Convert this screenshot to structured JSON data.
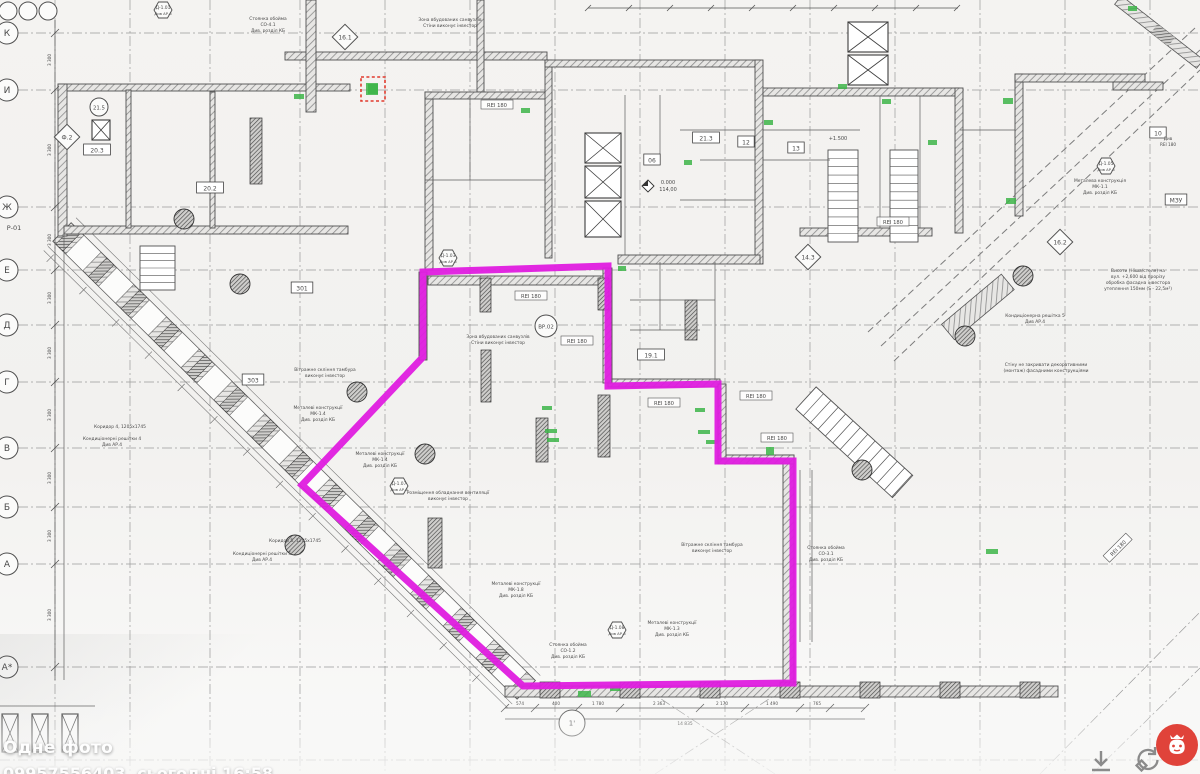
{
  "overlay": {
    "title": "Одне фото",
    "subtitle": "09957556403, сьогодні 16:58"
  },
  "controls": {
    "download_icon": "download-arrow",
    "rotate_icon": "rotate-ccw",
    "badge_icon": "red-moneybag-app-badge",
    "badge_color": "#e0433a"
  },
  "colors": {
    "magenta": "#df1cdf",
    "green": "#3db549",
    "red_dash": "#e23b2e",
    "ink": "#4a4a4a",
    "grid": "#9a9a9a"
  },
  "drawing": {
    "grid": {
      "vxs": [
        55,
        130,
        210,
        300,
        385,
        470,
        555,
        640,
        725,
        810,
        895,
        980,
        1065,
        1150
      ],
      "hys": [
        33,
        90,
        207,
        270,
        325,
        382,
        448,
        507,
        564,
        667,
        760
      ],
      "dash": "10 3 2 3"
    },
    "diag_axes": [
      [
        64,
        228,
        534,
        698
      ],
      [
        1040,
        774,
        1200,
        612
      ],
      [
        1092,
        774,
        1200,
        668
      ],
      [
        655,
        774,
        775,
        695
      ],
      [
        775,
        774,
        655,
        695
      ]
    ],
    "scallops": [
      [
        868,
        332,
        1195,
        28
      ],
      [
        881,
        346,
        1200,
        50
      ],
      [
        894,
        361,
        1200,
        70
      ]
    ],
    "facade": {
      "x": 62,
      "y": 232,
      "len": 652,
      "w": 26,
      "ang": 44.6,
      "step": 46
    },
    "tr_facade": {
      "x": 1118,
      "y": 0,
      "len": 104,
      "w": 11,
      "ang": 38
    },
    "ladder": {
      "x": 806,
      "y": 398,
      "len": 131,
      "w": 30,
      "ang": 42.5,
      "step": 10
    },
    "grate": {
      "x": 948,
      "y": 332,
      "len": 78,
      "w": 20,
      "ang": -40
    },
    "walls": [
      [
        58,
        84,
        292,
        7
      ],
      [
        58,
        84,
        9,
        152
      ],
      [
        64,
        226,
        284,
        8
      ],
      [
        126,
        90,
        5,
        138
      ],
      [
        210,
        92,
        5,
        136
      ],
      [
        285,
        52,
        262,
        8
      ],
      [
        306,
        0,
        10,
        112
      ],
      [
        477,
        0,
        7,
        92
      ],
      [
        425,
        92,
        8,
        178
      ],
      [
        425,
        92,
        122,
        7
      ],
      [
        545,
        60,
        7,
        198
      ],
      [
        545,
        60,
        215,
        7
      ],
      [
        755,
        60,
        8,
        204
      ],
      [
        763,
        88,
        196,
        8
      ],
      [
        955,
        88,
        8,
        145
      ],
      [
        618,
        255,
        142,
        9
      ],
      [
        800,
        228,
        132,
        8
      ],
      [
        1015,
        74,
        8,
        142
      ],
      [
        1015,
        74,
        130,
        8
      ],
      [
        1113,
        82,
        50,
        8
      ],
      [
        505,
        686,
        553,
        11
      ],
      [
        783,
        455,
        11,
        232
      ],
      [
        718,
        455,
        76,
        9
      ],
      [
        608,
        379,
        112,
        8
      ],
      [
        428,
        276,
        182,
        9
      ],
      [
        603,
        268,
        9,
        115
      ],
      [
        419,
        272,
        8,
        88
      ],
      [
        718,
        384,
        8,
        75
      ]
    ],
    "xrects": [
      [
        585,
        133,
        36,
        30
      ],
      [
        585,
        166,
        36,
        32
      ],
      [
        585,
        201,
        36,
        36
      ],
      [
        848,
        22,
        40,
        30
      ],
      [
        848,
        55,
        40,
        30
      ],
      [
        92,
        120,
        18,
        20
      ]
    ],
    "stairs": [
      [
        828,
        150,
        30,
        92,
        11
      ],
      [
        890,
        150,
        28,
        92,
        11
      ],
      [
        140,
        246,
        35,
        44,
        6
      ]
    ],
    "piers": [
      [
        480,
        278,
        11,
        34
      ],
      [
        598,
        278,
        11,
        32
      ],
      [
        598,
        395,
        12,
        62
      ],
      [
        481,
        350,
        10,
        52
      ],
      [
        536,
        418,
        12,
        44
      ],
      [
        428,
        518,
        14,
        50
      ],
      [
        250,
        118,
        12,
        66
      ],
      [
        685,
        300,
        12,
        40
      ],
      [
        540,
        682,
        20,
        16
      ],
      [
        620,
        682,
        20,
        16
      ],
      [
        700,
        682,
        20,
        16
      ],
      [
        780,
        682,
        20,
        16
      ],
      [
        860,
        682,
        20,
        16
      ],
      [
        940,
        682,
        20,
        16
      ],
      [
        1020,
        682,
        20,
        16
      ]
    ],
    "columns": [
      [
        184,
        219
      ],
      [
        240,
        284
      ],
      [
        357,
        392
      ],
      [
        425,
        454
      ],
      [
        295,
        545
      ],
      [
        1023,
        276
      ],
      [
        965,
        336
      ],
      [
        862,
        470
      ]
    ],
    "lines": [
      [
        425,
        180,
        545,
        180
      ],
      [
        470,
        95,
        470,
        180
      ],
      [
        625,
        95,
        625,
        255
      ],
      [
        660,
        95,
        660,
        160
      ],
      [
        680,
        130,
        755,
        130
      ],
      [
        700,
        160,
        755,
        160
      ],
      [
        680,
        200,
        755,
        200
      ],
      [
        763,
        130,
        860,
        130
      ],
      [
        763,
        160,
        830,
        160
      ],
      [
        880,
        96,
        880,
        228
      ],
      [
        920,
        96,
        920,
        228
      ],
      [
        960,
        130,
        1015,
        130
      ],
      [
        630,
        300,
        715,
        300
      ],
      [
        630,
        330,
        700,
        330
      ],
      [
        715,
        262,
        715,
        380
      ],
      [
        660,
        262,
        660,
        330
      ],
      [
        800,
        470,
        800,
        642
      ],
      [
        812,
        470,
        812,
        642
      ],
      [
        64,
        226,
        64,
        680
      ]
    ],
    "dims": {
      "left": {
        "x": 55,
        "y1": 20,
        "y2": 680,
        "ticks": [
          33,
          90,
          207,
          270,
          325,
          382,
          448,
          507,
          564,
          667
        ],
        "label": "3 300",
        "lys": [
          60,
          150,
          240,
          298,
          353,
          415,
          478,
          536,
          615
        ]
      },
      "bottom": {
        "y": 708,
        "x1": 505,
        "x2": 865,
        "ticks": [
          505,
          535,
          578,
          620,
          700,
          745,
          800,
          830,
          865
        ],
        "nums": [
          [
            "574",
            520
          ],
          [
            "400",
            556
          ],
          [
            "1 780",
            598
          ],
          [
            "2 363",
            659
          ],
          [
            "2 170",
            722
          ],
          [
            "1 490",
            772
          ],
          [
            "765",
            817
          ]
        ],
        "total": [
          "14 835",
          685,
          719
        ]
      },
      "top": {
        "y": 8,
        "x1": 588,
        "x2": 958,
        "step": 41
      }
    },
    "bubbles_left": [
      [
        "К",
        33
      ],
      [
        "И",
        90
      ],
      [
        "Ж",
        207
      ],
      [
        "Е",
        270
      ],
      [
        "Д",
        325
      ],
      [
        "Г",
        382
      ],
      [
        "В",
        448
      ],
      [
        "Б",
        507
      ],
      [
        "А",
        564
      ],
      [
        "А*",
        667
      ]
    ],
    "bubble_sub": [
      "Р-01",
      14,
      230
    ],
    "top_circles": [
      [
        8,
        11
      ],
      [
        28,
        11
      ],
      [
        48,
        11
      ]
    ],
    "diamonds": [
      [
        "16.1",
        345,
        37
      ],
      [
        "16.2",
        1060,
        242
      ],
      [
        "14.3",
        808,
        257
      ],
      [
        "Ф.2",
        67,
        137
      ]
    ],
    "circle_tags": [
      [
        "ВР.02",
        546,
        326,
        11
      ],
      [
        "21.5",
        99,
        107,
        9
      ],
      [
        "1'",
        572,
        723,
        13
      ]
    ],
    "hexes": [
      [
        "Д-1.03",
        448,
        258
      ],
      [
        "Д-1.07",
        399,
        486
      ],
      [
        "Д-1.08",
        617,
        630
      ],
      [
        "Д-1.05",
        1106,
        166
      ],
      [
        "Д-1.01",
        163,
        10
      ]
    ],
    "hex_sub": "Див АР.6",
    "tags": [
      [
        "06",
        652,
        160
      ],
      [
        "12",
        746,
        142
      ],
      [
        "13",
        796,
        148
      ],
      [
        "21.3",
        706,
        138
      ],
      [
        "19.1",
        651,
        355
      ],
      [
        "20.3",
        97,
        150
      ],
      [
        "20.2",
        210,
        188
      ],
      [
        "301",
        302,
        288
      ],
      [
        "303",
        253,
        380
      ],
      [
        "МЗУ",
        1176,
        200
      ],
      [
        "10",
        1158,
        133
      ]
    ],
    "rei_label": "REI 180",
    "rei": [
      [
        497,
        105,
        0
      ],
      [
        531,
        296,
        0
      ],
      [
        577,
        341,
        0
      ],
      [
        893,
        222,
        0
      ],
      [
        664,
        403,
        0
      ],
      [
        756,
        396,
        0
      ],
      [
        777,
        438,
        0
      ],
      [
        1118,
        548,
        -45
      ]
    ],
    "rei_note": [
      "Див",
      "REI 180"
    ],
    "rei_note_pos": [
      1168,
      140
    ],
    "elev": {
      "x": 648,
      "y": 186,
      "top": "0.000",
      "bot": "114,00"
    },
    "plus_mark": [
      "+1.500",
      838,
      140
    ],
    "texts": [
      [
        450,
        21,
        [
          "Зона вбудованих санвузлів",
          "Стіни виконує інвестор"
        ]
      ],
      [
        498,
        338,
        [
          "Зона вбудованих санвузлів",
          "Стіни виконує інвестор"
        ]
      ],
      [
        268,
        20,
        [
          "Стоянка обойма",
          "СО-4.1",
          "Див. розділ КБ"
        ]
      ],
      [
        568,
        646,
        [
          "Стоянка обойма",
          "СО-1.2",
          "Див. розділ КБ"
        ]
      ],
      [
        826,
        549,
        [
          "Стоянка обойма",
          "СО-3.1",
          "Див. розділ КБ"
        ]
      ],
      [
        325,
        371,
        [
          "Вітражне скління тамбура",
          "виконує інвестор"
        ]
      ],
      [
        712,
        546,
        [
          "Вітражне скління тамбура",
          "виконує інвестор"
        ]
      ],
      [
        318,
        409,
        [
          "Металеві конструкції",
          "МК-1.4",
          "Див. розділ КБ"
        ]
      ],
      [
        380,
        455,
        [
          "Металеві конструкції",
          "МК-1.4",
          "Див. розділ КБ"
        ]
      ],
      [
        516,
        585,
        [
          "Металеві конструкції",
          "МК-1.8",
          "Див. розділ КБ"
        ]
      ],
      [
        672,
        624,
        [
          "Металеві конструкції",
          "МК-1.3",
          "Див. розділ КБ"
        ]
      ],
      [
        1100,
        182,
        [
          "Металева конструкція",
          "МК-1.1",
          "Див. розділ КБ"
        ]
      ],
      [
        448,
        494,
        [
          "Розміщення обладнання вентиляції",
          "виконує інвестор"
        ]
      ],
      [
        120,
        428,
        [
          "Коридор 4, 1205х1745"
        ]
      ],
      [
        112,
        440,
        [
          "Кондиціонерні решітки 4",
          "Див АР.4"
        ]
      ],
      [
        295,
        542,
        [
          "Коридор 5, 1205х1745"
        ]
      ],
      [
        262,
        555,
        [
          "Кондиціонерні решітки 5",
          "Див АР.4"
        ]
      ],
      [
        1035,
        317,
        [
          "Кондиціонерна решітка 5",
          "Див АР.4"
        ]
      ],
      [
        1046,
        366,
        [
          "Стіну не закривати декоративними",
          "(монтаж) фасадними конструкціями"
        ]
      ],
      [
        1138,
        272,
        [
          "Висоти (Ніша/стеля) на",
          "вул. +2,600 від прорізу",
          "обробка фасадна інвестора",
          "утеплення 150мм (S - 22,5м²)"
        ]
      ]
    ],
    "green": [
      [
        294,
        94,
        10,
        5
      ],
      [
        366,
        83,
        12,
        12
      ],
      [
        521,
        108,
        9,
        5
      ],
      [
        545,
        429,
        12,
        4
      ],
      [
        547,
        438,
        12,
        4
      ],
      [
        698,
        430,
        12,
        4
      ],
      [
        706,
        440,
        12,
        4
      ],
      [
        764,
        120,
        9,
        5
      ],
      [
        838,
        84,
        9,
        5
      ],
      [
        882,
        99,
        9,
        5
      ],
      [
        928,
        140,
        9,
        5
      ],
      [
        610,
        686,
        10,
        5
      ],
      [
        578,
        691,
        13,
        6
      ],
      [
        986,
        549,
        12,
        5
      ],
      [
        1003,
        98,
        10,
        6
      ],
      [
        1006,
        198,
        10,
        6
      ],
      [
        542,
        406,
        10,
        4
      ],
      [
        695,
        408,
        10,
        4
      ],
      [
        766,
        447,
        8,
        8
      ],
      [
        1128,
        6,
        9,
        5
      ],
      [
        684,
        160,
        8,
        5
      ],
      [
        618,
        266,
        8,
        5
      ]
    ],
    "red_box": [
      361,
      77,
      24,
      24
    ],
    "magenta": {
      "pts": "423,272 608,266 608,386 718,384 718,461 793,461 793,683 523,686 302,485 423,357",
      "w": 7
    }
  }
}
